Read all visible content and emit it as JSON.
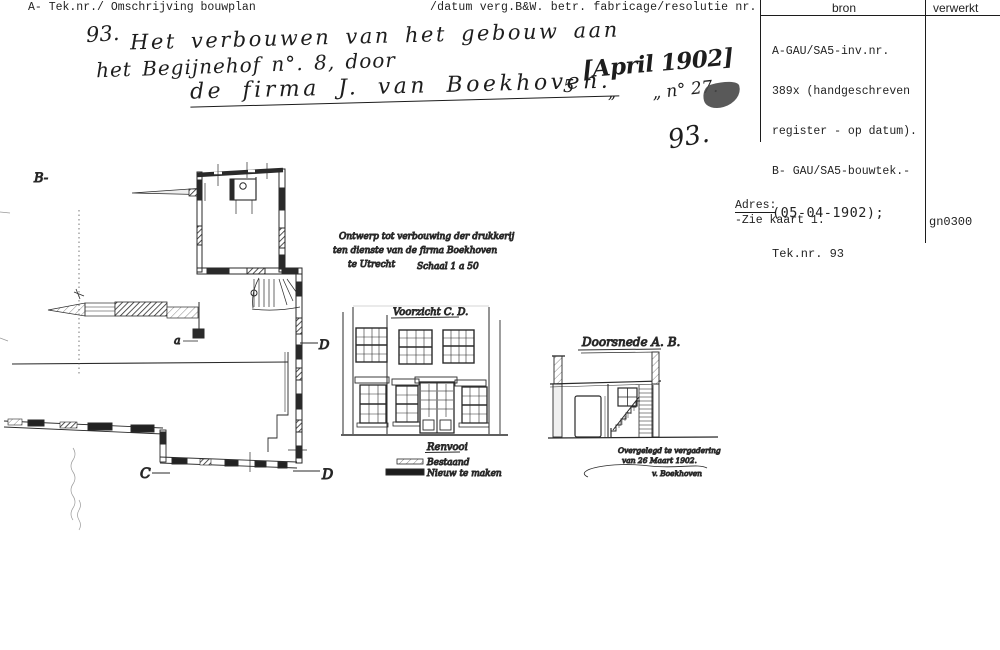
{
  "colors": {
    "ink": "#1f1f1f",
    "paper": "#ffffff"
  },
  "header": {
    "left_label": "A- Tek.nr./ Omschrijving bouwplan",
    "middle_label": "/datum verg.B&W. betr. fabricage/resolutie nr."
  },
  "source_table": {
    "col_bron": "bron",
    "col_verwerkt": "verwerkt",
    "lines": [
      "A-GAU/SA5-inv.nr.",
      "389x (handgeschreven",
      "register - op datum).",
      "B- GAU/SA5-bouwtek.-",
      "(05-04-1902);",
      "Tek.nr. 93"
    ],
    "code": "gn0300",
    "adres_label": "Adres:",
    "adres_value": "-Zie kaart 1."
  },
  "handwritten_header": {
    "item_number": "93.",
    "line1": "Het verbouwen van het gebouw aan",
    "line2": "het Begijnehof n°. 8, door",
    "line3": "de firma J. van Boekhoven.",
    "date_prefix": "5",
    "date": "[April 1902]",
    "ditto": "„",
    "resolution": "„ n° 27.",
    "big_number": "93."
  },
  "plan": {
    "label_b": "B-",
    "label_a": "a",
    "label_c": "C",
    "label_d_top": "D",
    "label_d_bottom": "D"
  },
  "elevation": {
    "note_line1": "Ontwerp tot verbouwing der drukkerij",
    "note_line2": "ten dienste van de firma Boekhoven",
    "note_line3": "te Utrecht",
    "note_scale": "Schaal 1 a 50",
    "title": "Voorzicht C. D.",
    "legend_title": "Renvooi",
    "legend": [
      {
        "swatch": "hatched-bar",
        "label": "Bestaand"
      },
      {
        "swatch": "solid-bar",
        "label": "Nieuw te maken"
      }
    ]
  },
  "section": {
    "title": "Doorsnede A. B.",
    "note_line1": "Overgelegd te vergadering",
    "note_line2": "van 26 Maart 1902.",
    "signature": "v. Boekhoven"
  }
}
